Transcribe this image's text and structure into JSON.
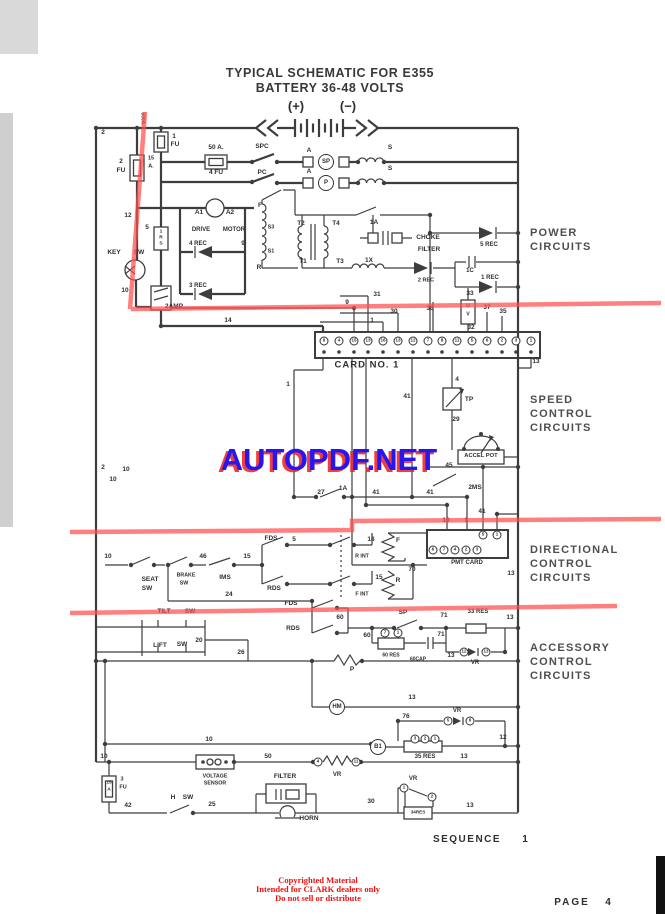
{
  "page": {
    "title_line1": "TYPICAL SCHEMATIC FOR E355",
    "title_line2": "BATTERY 36-48 VOLTS"
  },
  "watermark": {
    "text": "AUTOPDF.NET",
    "color_front": "#2616f0",
    "color_shadow": "#f02828"
  },
  "copyright": {
    "color": "#ee1111",
    "lines": [
      "Copyrighted Material",
      "Intended for CLARK dealers only",
      "Do not sell or distribute"
    ]
  },
  "annotations": {
    "marker_color": "#ff4d4d"
  },
  "schematic": {
    "ink_color": "#3d3d3d",
    "sections": [
      {
        "id": "power",
        "x": 530,
        "y": 226,
        "lines": [
          "POWER",
          "CIRCUITS"
        ]
      },
      {
        "id": "speed",
        "x": 530,
        "y": 393,
        "lines": [
          "SPEED",
          "CONTROL",
          "CIRCUITS"
        ]
      },
      {
        "id": "directional",
        "x": 530,
        "y": 543,
        "lines": [
          "DIRECTIONAL",
          "CONTROL",
          "CIRCUITS"
        ]
      },
      {
        "id": "accessory",
        "x": 530,
        "y": 641,
        "lines": [
          "ACCESSORY",
          "CONTROL",
          "CIRCUITS"
        ]
      }
    ],
    "labels": [
      {
        "t": "(+)",
        "x": 296,
        "y": 106,
        "s": 13
      },
      {
        "t": "(−)",
        "x": 348,
        "y": 106,
        "s": 13
      },
      {
        "t": "2",
        "x": 103,
        "y": 133
      },
      {
        "t": "500A.",
        "x": 142,
        "y": 119,
        "s": 5,
        "r": 1
      },
      {
        "t": "1",
        "x": 174,
        "y": 137
      },
      {
        "t": "FU",
        "x": 175,
        "y": 145
      },
      {
        "t": "2",
        "x": 121,
        "y": 162
      },
      {
        "t": "FU",
        "x": 121,
        "y": 171
      },
      {
        "t": "15",
        "x": 151,
        "y": 159,
        "s": 5.5
      },
      {
        "t": "A.",
        "x": 151,
        "y": 167,
        "s": 5.5
      },
      {
        "t": "50 A.",
        "x": 216,
        "y": 148
      },
      {
        "t": "4 FU",
        "x": 216,
        "y": 173
      },
      {
        "t": "SPC",
        "x": 262,
        "y": 147
      },
      {
        "t": "PC",
        "x": 262,
        "y": 173
      },
      {
        "t": "A",
        "x": 309,
        "y": 151
      },
      {
        "t": "A",
        "x": 309,
        "y": 172
      },
      {
        "t": "S",
        "x": 390,
        "y": 148
      },
      {
        "t": "S",
        "x": 390,
        "y": 169
      },
      {
        "t": "SP",
        "x": 326,
        "y": 162,
        "c": "lg"
      },
      {
        "t": "P",
        "x": 326,
        "y": 183,
        "c": "lg"
      },
      {
        "t": "12",
        "x": 128,
        "y": 216
      },
      {
        "t": "5",
        "x": 147,
        "y": 228
      },
      {
        "t": "1",
        "x": 161,
        "y": 233,
        "s": 4.8
      },
      {
        "t": "R",
        "x": 161,
        "y": 239,
        "s": 4.8
      },
      {
        "t": "S",
        "x": 161,
        "y": 245,
        "s": 4.8
      },
      {
        "t": "A1",
        "x": 199,
        "y": 213
      },
      {
        "t": "A2",
        "x": 230,
        "y": 213
      },
      {
        "t": "DRIVE",
        "x": 201,
        "y": 230,
        "s": 6
      },
      {
        "t": "MOTOR",
        "x": 234,
        "y": 230,
        "s": 6
      },
      {
        "t": "4 REC",
        "x": 198,
        "y": 244,
        "s": 6
      },
      {
        "t": "3 REC",
        "x": 198,
        "y": 286,
        "s": 6
      },
      {
        "t": "9",
        "x": 243,
        "y": 244
      },
      {
        "t": "F",
        "x": 260,
        "y": 206
      },
      {
        "t": "S3",
        "x": 271,
        "y": 228,
        "s": 5.5
      },
      {
        "t": "S1",
        "x": 271,
        "y": 252,
        "s": 5.5
      },
      {
        "t": "R",
        "x": 259,
        "y": 268
      },
      {
        "t": "KEY",
        "x": 114,
        "y": 253
      },
      {
        "t": "SW",
        "x": 139,
        "y": 253
      },
      {
        "t": "10",
        "x": 125,
        "y": 291
      },
      {
        "t": "2AMP",
        "x": 174,
        "y": 307
      },
      {
        "t": "14",
        "x": 228,
        "y": 321
      },
      {
        "t": "T2",
        "x": 301,
        "y": 224
      },
      {
        "t": "T4",
        "x": 336,
        "y": 224
      },
      {
        "t": "T1",
        "x": 303,
        "y": 262
      },
      {
        "t": "T3",
        "x": 340,
        "y": 262
      },
      {
        "t": "1A",
        "x": 374,
        "y": 223
      },
      {
        "t": "1X",
        "x": 369,
        "y": 261
      },
      {
        "t": "CHOKE",
        "x": 428,
        "y": 238,
        "s": 6.5
      },
      {
        "t": "FILTER",
        "x": 429,
        "y": 250,
        "s": 6.5
      },
      {
        "t": "5 REC",
        "x": 489,
        "y": 245,
        "s": 6
      },
      {
        "t": "1C",
        "x": 470,
        "y": 271,
        "s": 6
      },
      {
        "t": "1 REC",
        "x": 490,
        "y": 278,
        "s": 6
      },
      {
        "t": "2 REC",
        "x": 426,
        "y": 281,
        "s": 5.5
      },
      {
        "t": "U",
        "x": 468,
        "y": 307,
        "s": 5
      },
      {
        "t": "V",
        "x": 468,
        "y": 315,
        "s": 5
      },
      {
        "t": "9",
        "x": 347,
        "y": 303
      },
      {
        "t": "31",
        "x": 377,
        "y": 295
      },
      {
        "t": "30",
        "x": 394,
        "y": 312
      },
      {
        "t": "1",
        "x": 372,
        "y": 321
      },
      {
        "t": "36",
        "x": 430,
        "y": 309
      },
      {
        "t": "33",
        "x": 470,
        "y": 294
      },
      {
        "t": "32",
        "x": 471,
        "y": 328
      },
      {
        "t": "37",
        "x": 487,
        "y": 308
      },
      {
        "t": "35",
        "x": 503,
        "y": 312
      },
      {
        "t": "13",
        "x": 536,
        "y": 362
      },
      {
        "t": "CARD  NO. 1",
        "x": 367,
        "y": 365,
        "s": 9.5,
        "ls": 1
      },
      {
        "t": "9",
        "x": 324,
        "y": 341,
        "c": "sm"
      },
      {
        "t": "4",
        "x": 339,
        "y": 341,
        "c": "sm"
      },
      {
        "t": "15",
        "x": 354,
        "y": 341,
        "c": "sm"
      },
      {
        "t": "13",
        "x": 368,
        "y": 341,
        "c": "sm"
      },
      {
        "t": "16",
        "x": 383,
        "y": 341,
        "c": "sm"
      },
      {
        "t": "13",
        "x": 398,
        "y": 341,
        "c": "sm"
      },
      {
        "t": "12",
        "x": 413,
        "y": 341,
        "c": "sm"
      },
      {
        "t": "7",
        "x": 428,
        "y": 341,
        "c": "sm"
      },
      {
        "t": "8",
        "x": 442,
        "y": 341,
        "c": "sm"
      },
      {
        "t": "11",
        "x": 457,
        "y": 341,
        "c": "sm"
      },
      {
        "t": "5",
        "x": 472,
        "y": 341,
        "c": "sm"
      },
      {
        "t": "6",
        "x": 487,
        "y": 341,
        "c": "sm"
      },
      {
        "t": "2",
        "x": 502,
        "y": 341,
        "c": "sm"
      },
      {
        "t": "3",
        "x": 516,
        "y": 341,
        "c": "sm"
      },
      {
        "t": "1",
        "x": 531,
        "y": 341,
        "c": "sm"
      },
      {
        "t": "4",
        "x": 457,
        "y": 380
      },
      {
        "t": "TP",
        "x": 469,
        "y": 400
      },
      {
        "t": "29",
        "x": 456,
        "y": 420
      },
      {
        "t": "ACCEL  POT",
        "x": 481,
        "y": 457,
        "s": 5.8
      },
      {
        "t": "45",
        "x": 449,
        "y": 466
      },
      {
        "t": "2MS",
        "x": 475,
        "y": 488
      },
      {
        "t": "41",
        "x": 407,
        "y": 397
      },
      {
        "t": "2",
        "x": 103,
        "y": 468
      },
      {
        "t": "10",
        "x": 113,
        "y": 480
      },
      {
        "t": "10",
        "x": 126,
        "y": 470
      },
      {
        "t": "1",
        "x": 288,
        "y": 385
      },
      {
        "t": "27",
        "x": 321,
        "y": 493
      },
      {
        "t": "1A",
        "x": 343,
        "y": 489
      },
      {
        "t": "41",
        "x": 376,
        "y": 493
      },
      {
        "t": "41",
        "x": 430,
        "y": 493
      },
      {
        "t": "41",
        "x": 482,
        "y": 512
      },
      {
        "t": "10",
        "x": 446,
        "y": 521
      },
      {
        "t": "1",
        "x": 466,
        "y": 521
      },
      {
        "t": "18",
        "x": 371,
        "y": 540
      },
      {
        "t": "R INT",
        "x": 362,
        "y": 557,
        "s": 5.3
      },
      {
        "t": "F INT",
        "x": 362,
        "y": 595,
        "s": 5.3
      },
      {
        "t": "F",
        "x": 398,
        "y": 541
      },
      {
        "t": "R",
        "x": 398,
        "y": 581
      },
      {
        "t": "15",
        "x": 379,
        "y": 578
      },
      {
        "t": "70",
        "x": 412,
        "y": 570
      },
      {
        "t": "PMT CARD",
        "x": 467,
        "y": 563,
        "s": 6
      },
      {
        "t": "13",
        "x": 511,
        "y": 574
      },
      {
        "t": "6",
        "x": 433,
        "y": 550,
        "c": "sm"
      },
      {
        "t": "7",
        "x": 444,
        "y": 550,
        "c": "sm"
      },
      {
        "t": "4",
        "x": 455,
        "y": 550,
        "c": "sm"
      },
      {
        "t": "2",
        "x": 466,
        "y": 550,
        "c": "sm"
      },
      {
        "t": "3",
        "x": 477,
        "y": 550,
        "c": "sm"
      },
      {
        "t": "5",
        "x": 483,
        "y": 535,
        "c": "sm"
      },
      {
        "t": "1",
        "x": 497,
        "y": 535,
        "c": "sm"
      },
      {
        "t": "10",
        "x": 108,
        "y": 557
      },
      {
        "t": "SEAT",
        "x": 150,
        "y": 580
      },
      {
        "t": "SW",
        "x": 147,
        "y": 589
      },
      {
        "t": "BRAKE",
        "x": 186,
        "y": 576,
        "s": 5.3
      },
      {
        "t": "SW",
        "x": 184,
        "y": 584,
        "s": 5.3
      },
      {
        "t": "IMS",
        "x": 225,
        "y": 578
      },
      {
        "t": "46",
        "x": 203,
        "y": 557
      },
      {
        "t": "15",
        "x": 247,
        "y": 557
      },
      {
        "t": "FDS",
        "x": 271,
        "y": 539
      },
      {
        "t": "5",
        "x": 294,
        "y": 540
      },
      {
        "t": "RDS",
        "x": 274,
        "y": 589
      },
      {
        "t": "24",
        "x": 229,
        "y": 595
      },
      {
        "t": "TILT",
        "x": 164,
        "y": 612
      },
      {
        "t": "SW",
        "x": 190,
        "y": 612
      },
      {
        "t": "LIFT",
        "x": 160,
        "y": 646
      },
      {
        "t": "SW",
        "x": 182,
        "y": 645
      },
      {
        "t": "20",
        "x": 199,
        "y": 641
      },
      {
        "t": "FDS",
        "x": 291,
        "y": 604
      },
      {
        "t": "RDS",
        "x": 293,
        "y": 629
      },
      {
        "t": "60",
        "x": 340,
        "y": 618
      },
      {
        "t": "26",
        "x": 241,
        "y": 653
      },
      {
        "t": "SP",
        "x": 403,
        "y": 613
      },
      {
        "t": "71",
        "x": 444,
        "y": 616
      },
      {
        "t": "33 RES",
        "x": 478,
        "y": 612,
        "s": 6
      },
      {
        "t": "13",
        "x": 510,
        "y": 618
      },
      {
        "t": "60",
        "x": 367,
        "y": 636
      },
      {
        "t": "7",
        "x": 385,
        "y": 633,
        "c": "sm"
      },
      {
        "t": "1",
        "x": 398,
        "y": 633,
        "c": "sm"
      },
      {
        "t": "60 RES",
        "x": 391,
        "y": 656,
        "s": 5
      },
      {
        "t": "60CAP",
        "x": 418,
        "y": 660,
        "s": 5
      },
      {
        "t": "71",
        "x": 441,
        "y": 635
      },
      {
        "t": "12",
        "x": 464,
        "y": 652,
        "c": "sm"
      },
      {
        "t": "13",
        "x": 486,
        "y": 652,
        "c": "sm"
      },
      {
        "t": "VR",
        "x": 475,
        "y": 663,
        "s": 6
      },
      {
        "t": "P",
        "x": 352,
        "y": 670
      },
      {
        "t": "13",
        "x": 451,
        "y": 656
      },
      {
        "t": "HM",
        "x": 337,
        "y": 707,
        "c": "lg"
      },
      {
        "t": "13",
        "x": 412,
        "y": 698
      },
      {
        "t": "76",
        "x": 406,
        "y": 717
      },
      {
        "t": "VR",
        "x": 457,
        "y": 711,
        "s": 6
      },
      {
        "t": "5",
        "x": 448,
        "y": 721,
        "c": "sm"
      },
      {
        "t": "6",
        "x": 470,
        "y": 721,
        "c": "sm"
      },
      {
        "t": "B1",
        "x": 378,
        "y": 747,
        "c": "lg"
      },
      {
        "t": "3",
        "x": 415,
        "y": 739,
        "c": "sm"
      },
      {
        "t": "2",
        "x": 425,
        "y": 739,
        "c": "sm"
      },
      {
        "t": "1",
        "x": 435,
        "y": 739,
        "c": "sm"
      },
      {
        "t": "35 RES",
        "x": 425,
        "y": 757,
        "s": 6
      },
      {
        "t": "12",
        "x": 503,
        "y": 738
      },
      {
        "t": "13",
        "x": 464,
        "y": 757
      },
      {
        "t": "10",
        "x": 209,
        "y": 740
      },
      {
        "t": "10",
        "x": 104,
        "y": 757
      },
      {
        "t": "VOLTAGE",
        "x": 215,
        "y": 777,
        "s": 5.3
      },
      {
        "t": "SENSOR",
        "x": 215,
        "y": 784,
        "s": 5.3
      },
      {
        "t": "50",
        "x": 268,
        "y": 757
      },
      {
        "t": "4",
        "x": 318,
        "y": 762,
        "c": "sm"
      },
      {
        "t": "11",
        "x": 356,
        "y": 762,
        "c": "sm"
      },
      {
        "t": "VR",
        "x": 337,
        "y": 775,
        "s": 6
      },
      {
        "t": "15",
        "x": 109,
        "y": 784,
        "s": 4.8
      },
      {
        "t": "A",
        "x": 109,
        "y": 791,
        "s": 4.8
      },
      {
        "t": "3",
        "x": 122,
        "y": 780,
        "s": 5.5
      },
      {
        "t": "FU",
        "x": 123,
        "y": 788,
        "s": 5.5
      },
      {
        "t": "42",
        "x": 128,
        "y": 806
      },
      {
        "t": "H",
        "x": 173,
        "y": 798
      },
      {
        "t": "SW",
        "x": 188,
        "y": 798
      },
      {
        "t": "25",
        "x": 212,
        "y": 805
      },
      {
        "t": "FILTER",
        "x": 285,
        "y": 777,
        "s": 6.5
      },
      {
        "t": "HORN",
        "x": 309,
        "y": 819,
        "s": 6.5
      },
      {
        "t": "30",
        "x": 371,
        "y": 802
      },
      {
        "t": "VR",
        "x": 413,
        "y": 779,
        "s": 6
      },
      {
        "t": "1",
        "x": 404,
        "y": 788,
        "c": "sm"
      },
      {
        "t": "2",
        "x": 432,
        "y": 797,
        "c": "sm"
      },
      {
        "t": "34RES",
        "x": 418,
        "y": 813,
        "s": 4.6
      },
      {
        "t": "13",
        "x": 470,
        "y": 806
      },
      {
        "t": "SEQUENCE",
        "x": 467,
        "y": 840,
        "s": 10,
        "ls": 1.5
      },
      {
        "t": "1",
        "x": 525,
        "y": 840,
        "s": 10
      },
      {
        "t": "PAGE",
        "x": 572,
        "y": 903,
        "s": 10,
        "ls": 2
      },
      {
        "t": "4",
        "x": 608,
        "y": 903,
        "s": 10
      }
    ]
  }
}
